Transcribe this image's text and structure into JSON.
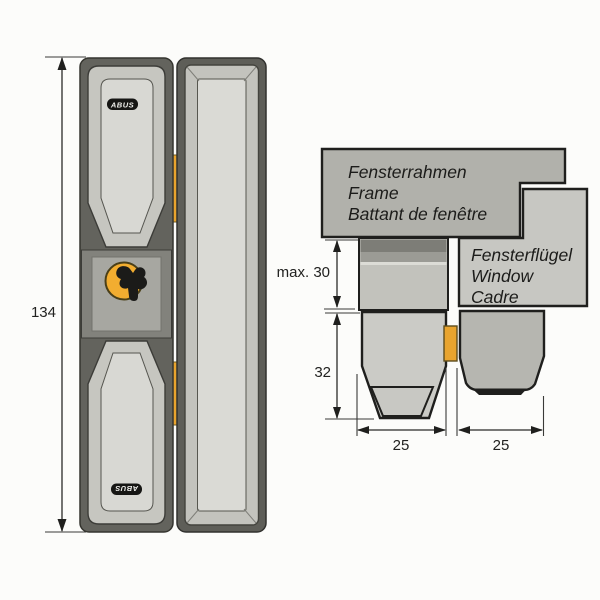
{
  "diagram": {
    "front_view": {
      "height_dim": {
        "label": "134"
      },
      "logo_top": "ABUS",
      "logo_bottom": "ABUS"
    },
    "section_view": {
      "frame_label": {
        "line1": "Fensterrahmen",
        "line2": "Frame",
        "line3": "Battant de fenêtre"
      },
      "sash_label": {
        "line1": "Fensterflügel",
        "line2": "Window",
        "line3": "Cadre"
      },
      "dims": {
        "frame_depth": "max. 30",
        "body_height": "32",
        "frame_width": "25",
        "sash_width": "25"
      }
    }
  },
  "colors": {
    "accent_bolt": "#e9a42e",
    "accent_cylinder": "#f2ad30",
    "frame_box_fill": "#b1b1ab",
    "sash_box_fill": "#c7c7c2",
    "section_frame_dark": "#7d7d77",
    "section_frame_mid": "#9b9b95",
    "section_body_fill": "#cbcbc6",
    "section_sash_fill": "#b6b6b0",
    "line": "#1f1f1d",
    "background": "#fcfcfa"
  },
  "icons": {
    "cylinder_emblem": "key-emblem-icon"
  }
}
